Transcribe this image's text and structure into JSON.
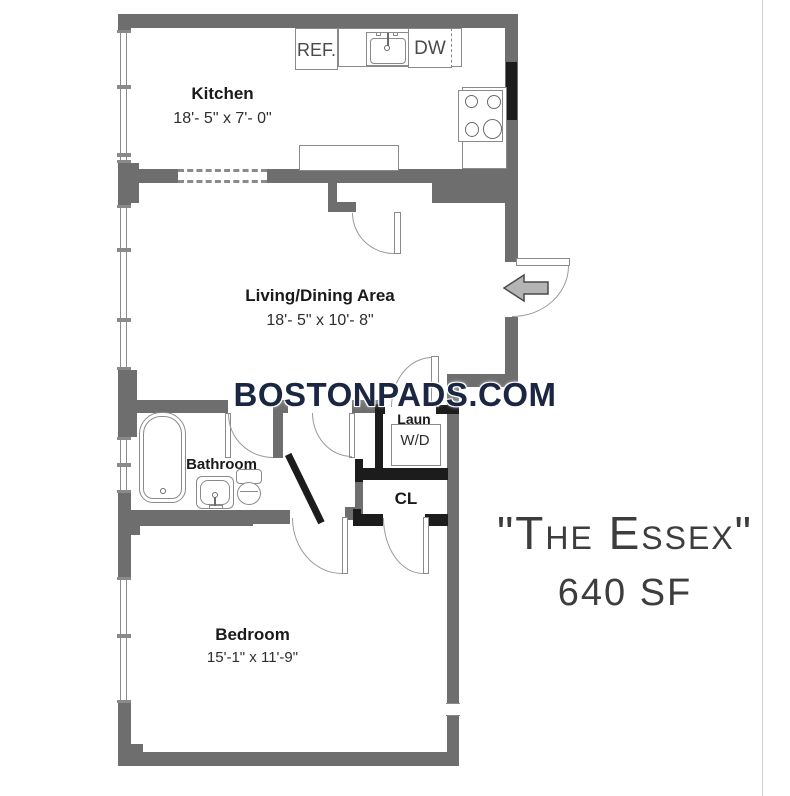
{
  "floorplan": {
    "watermark": "BOSTONPADS.COM",
    "title": "\"The Essex\"",
    "area": "640 SF",
    "rooms": {
      "kitchen": {
        "name": "Kitchen",
        "dims": "18'- 5\" x 7'- 0\""
      },
      "living": {
        "name": "Living/Dining Area",
        "dims": "18'- 5\" x 10'- 8\""
      },
      "bathroom": {
        "name": "Bathroom"
      },
      "laundry": {
        "name": "Laun",
        "unit": "W/D"
      },
      "closet": {
        "name": "CL"
      },
      "bedroom": {
        "name": "Bedroom",
        "dims": "15'-1\" x 11'-9\""
      }
    },
    "appliances": {
      "refrigerator": "REF.",
      "dishwasher": "DW"
    },
    "colors": {
      "wall": "#6e6e6e",
      "black_wall": "#1c1c1c",
      "watermark": "#1b2742",
      "title": "#3d3d3d",
      "arrow_fill": "#b4b4b4",
      "line": "#8a8a8a"
    }
  }
}
